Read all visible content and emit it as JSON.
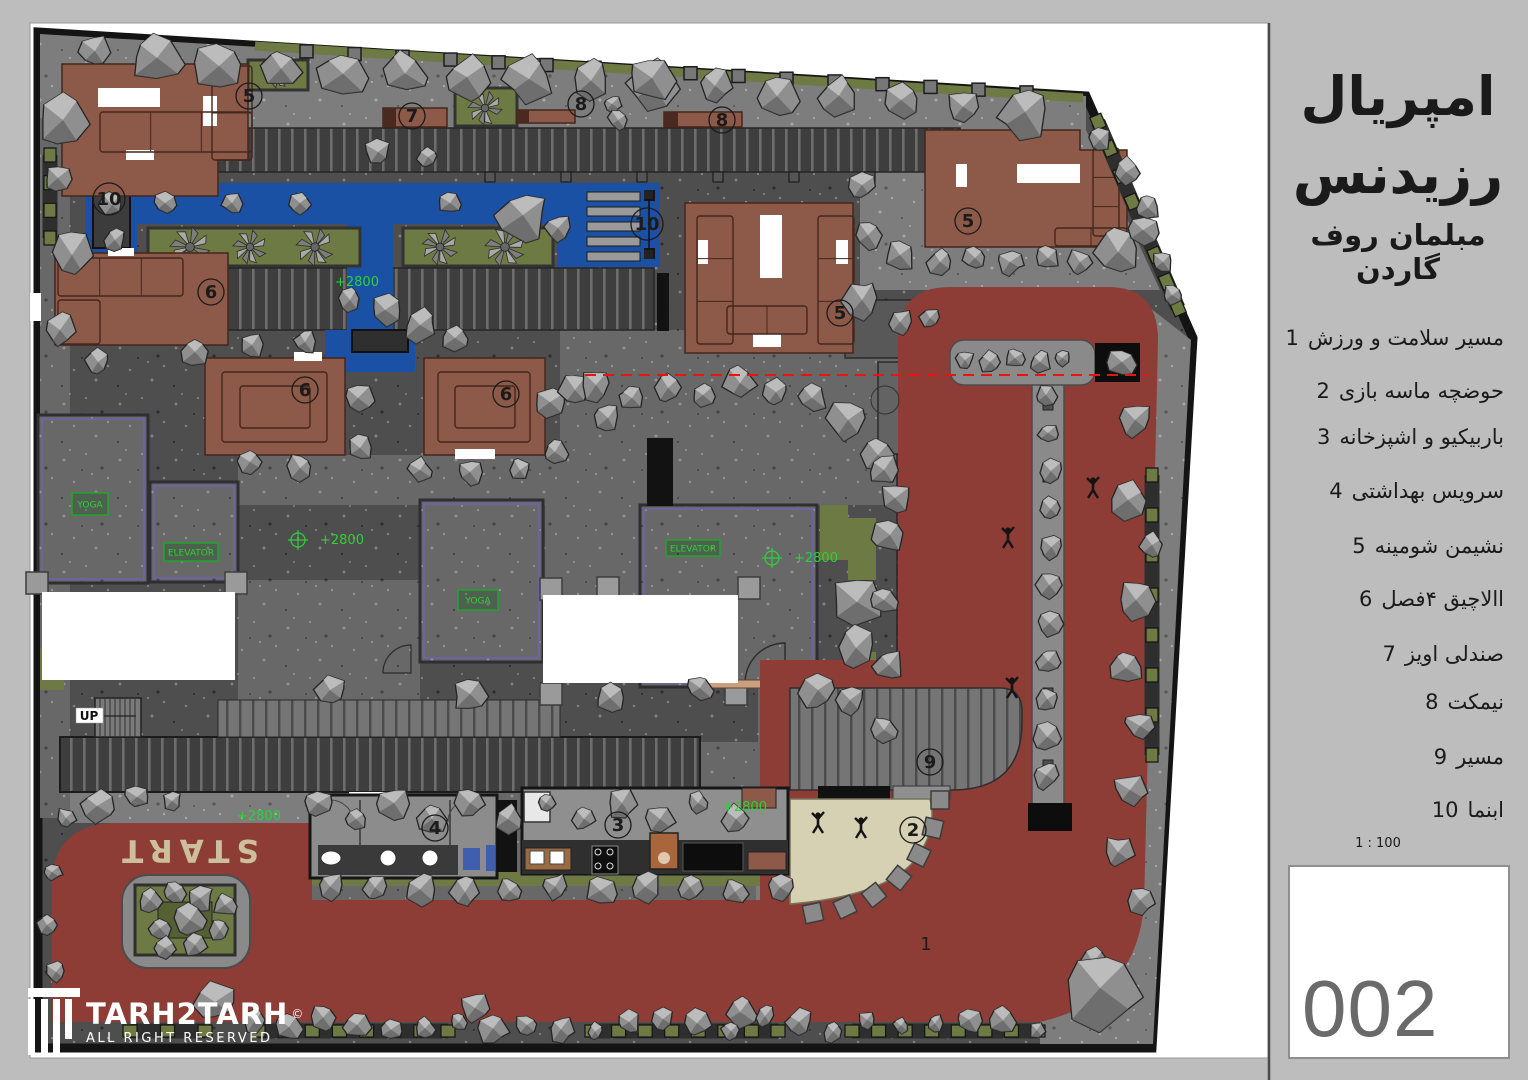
{
  "panel": {
    "title_line1": "امپریال",
    "title_line2": "رزیدنس",
    "subtitle": "مبلمان روف گاردن",
    "legend": [
      {
        "num": "1",
        "label": "مسیر سلامت و ورزش"
      },
      {
        "num": "2",
        "label": "حوضچه ماسه بازی"
      },
      {
        "num": "3",
        "label": "باربیکیو و اشپزخانه"
      },
      {
        "num": "4",
        "label": "سرویس بهداشتی"
      },
      {
        "num": "5",
        "label": "نشیمن شومینه"
      },
      {
        "num": "6",
        "label": "االاچیق ۴فصل"
      },
      {
        "num": "7",
        "label": "صندلی اویز"
      },
      {
        "num": "8",
        "label": "نیمکت"
      },
      {
        "num": "9",
        "label": "مسیر"
      },
      {
        "num": "10",
        "label": "ابنما"
      }
    ],
    "scale": "1 : 100",
    "sheet_number": "002"
  },
  "logo": {
    "name": "TARH2TARH",
    "copyright": "©",
    "tagline": "ALL RIGHT RESERVED",
    "icon": "column-icon"
  },
  "plan": {
    "texts": {
      "start": "START",
      "up": "UP",
      "track_number": "1"
    },
    "callouts": [
      {
        "n": "5",
        "x": 249,
        "y": 96
      },
      {
        "n": "8",
        "x": 581,
        "y": 104
      },
      {
        "n": "7",
        "x": 412,
        "y": 116
      },
      {
        "n": "8",
        "x": 722,
        "y": 120
      },
      {
        "n": "10",
        "x": 109,
        "y": 199
      },
      {
        "n": "10",
        "x": 647,
        "y": 224
      },
      {
        "n": "6",
        "x": 211,
        "y": 292
      },
      {
        "n": "5",
        "x": 968,
        "y": 221
      },
      {
        "n": "5",
        "x": 840,
        "y": 313
      },
      {
        "n": "6",
        "x": 305,
        "y": 390
      },
      {
        "n": "6",
        "x": 506,
        "y": 394
      },
      {
        "n": "9",
        "x": 930,
        "y": 762
      },
      {
        "n": "4",
        "x": 435,
        "y": 828
      },
      {
        "n": "3",
        "x": 618,
        "y": 825
      },
      {
        "n": "2",
        "x": 913,
        "y": 830
      }
    ],
    "elevation_tags": [
      {
        "text": "+2800",
        "x": 315,
        "y": 286,
        "cross": false
      },
      {
        "text": "+2800",
        "x": 300,
        "y": 544,
        "cross": true
      },
      {
        "text": "+2800",
        "x": 774,
        "y": 562,
        "cross": true
      },
      {
        "text": "+2800",
        "x": 703,
        "y": 811,
        "cross": false
      },
      {
        "text": "+2800",
        "x": 217,
        "y": 820,
        "cross": false
      }
    ],
    "room_tags": [
      {
        "text": "YOGA",
        "x": 72,
        "y": 493,
        "w": 36,
        "h": 22
      },
      {
        "text": "ELEVATOR",
        "x": 164,
        "y": 543,
        "w": 54,
        "h": 18
      },
      {
        "text": "YOGA",
        "x": 458,
        "y": 590,
        "w": 40,
        "h": 20
      },
      {
        "text": "ELEVATOR",
        "x": 666,
        "y": 540,
        "w": 54,
        "h": 16
      }
    ],
    "colors": {
      "page": "#bdbdbd",
      "sheet": "#ffffff",
      "ground": "#4e4e4e",
      "ground_light": "#7d7d7d",
      "ground_mid": "#686868",
      "wall": "#141414",
      "track": "#8d3d36",
      "pergola": "#1b51a5",
      "furniture": "#8d5a49",
      "furniture_line": "#45261c",
      "planting": "#6d7a44",
      "sand": "#d6d1b2",
      "tree": "#8f8f8f",
      "tree_light": "#c4c4c4",
      "tree_dark": "#5f5f5f",
      "section_line": "#ee1111",
      "tag_green": "#2dd138",
      "start_text": "#cdbf9b",
      "building": "#6e6e72",
      "building_accent": "#6f62b8"
    }
  }
}
